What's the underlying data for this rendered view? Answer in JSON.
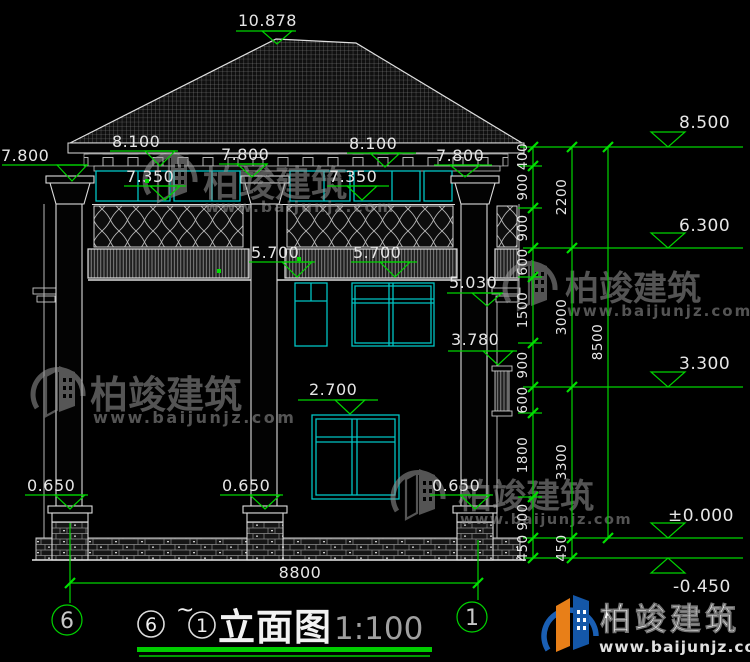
{
  "colors": {
    "background": "#000000",
    "line_white": "#dcdcdc",
    "dimension_green": "#00d400",
    "window_cyan": "#00c4c4",
    "watermark_gray": "#9a9a9a",
    "logo_blue": "#1a5fb4",
    "logo_orange": "#e87f18"
  },
  "markers": {
    "peak": "10.878",
    "eave": [
      "7.800",
      "8.100",
      "7.800",
      "8.100",
      "7.800"
    ],
    "clerestory": [
      "7.350",
      "7.350"
    ],
    "balcony": [
      "5.700",
      "5.700"
    ],
    "slab2": "5.030",
    "corbel": "3.780",
    "window1": "2.700",
    "pedestal": [
      "0.650",
      "0.650",
      "0.650"
    ]
  },
  "dims": {
    "width": "8800"
  },
  "axes": {
    "left": "6",
    "right": "1"
  },
  "right_dims": {
    "levels": [
      "8.500",
      "6.300",
      "3.300",
      "±0.000",
      "-0.450"
    ],
    "chain_inner": [
      "400",
      "900",
      "900",
      "600",
      "1500",
      "900",
      "600",
      "1800",
      "900",
      "450"
    ],
    "chain_mid": [
      "2200",
      "3000",
      "3300",
      "450"
    ],
    "chain_outer": [
      "8500"
    ]
  },
  "title": {
    "axis_from": "6",
    "tilde": "~",
    "axis_to": "1",
    "name": "立面图",
    "scale": "1:100"
  },
  "brand": {
    "name": "柏竣建筑",
    "url": "www.baijunjz.com"
  }
}
